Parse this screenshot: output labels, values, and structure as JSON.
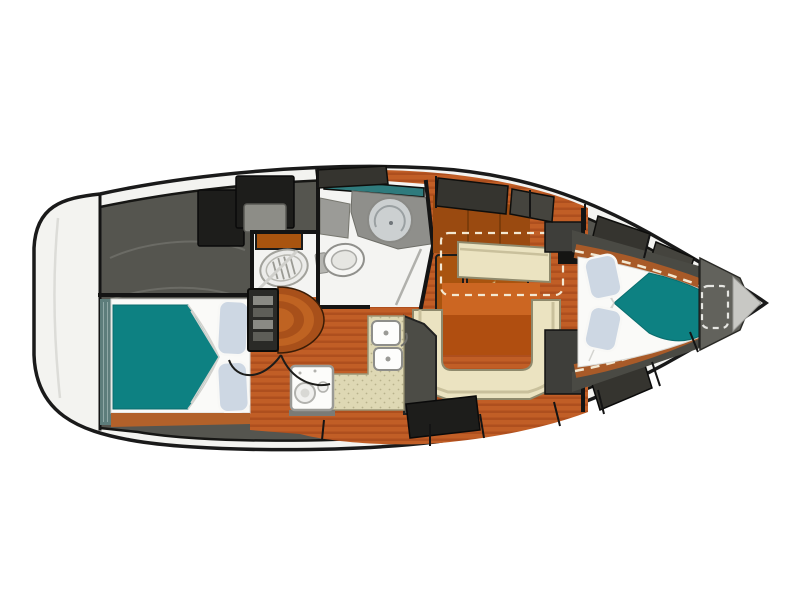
{
  "plan": {
    "kind": "sailboat-interior-floor-plan",
    "view": "top-down",
    "bow_direction": "right",
    "regions": [
      "swim-platform",
      "cockpit-storage",
      "aft-cabin-double-berth",
      "companionway-steps",
      "shower-room",
      "head-compartment",
      "companionway-entrance",
      "galley",
      "salon-settee",
      "salon-table",
      "nav-area",
      "v-berth-forward-cabin",
      "anchor-locker",
      "bow-tip"
    ],
    "arrow_meaning": "entrance-direction-arrow"
  },
  "palette": {
    "background": "#ffffff",
    "hull_fill": "#f3f3f0",
    "hull_outline": "#1a1a1a",
    "deck_gray": "#55554f",
    "deck_hatch_dark": "#35342f",
    "deck_hatch_mid": "#45443e",
    "deck_black": "#1d1d1b",
    "cockpit_panel": "#8d8d87",
    "floor_orange": "#c15e26",
    "floor_stripe": "#a8491a",
    "wood_trim": "#a85a28",
    "wood_shelf": "#b2612a",
    "cabinet_orange": "#a9540f",
    "cabinet_back": "#9a4a10",
    "table_top": "#cc6622",
    "table_base": "#b04e10",
    "steps_dark": "#a8501a",
    "steps_light": "#bf6322",
    "steps_cap": "#2a2a27",
    "settee_cream": "#ebe3c1",
    "settee_trim": "#c9c09c",
    "counter_speckle": "#ded8b4",
    "galley_wall": "#4c4c46",
    "bed_teal": "#0d8182",
    "mattress_white": "#fafaf8",
    "pillow_blue": "#cdd7e3",
    "bedhead_teal": "#5d7d7b",
    "bath_floor": "#f4f4f2",
    "fixture_gray": "#8f8f8b",
    "fixture_light": "#ccd0d1",
    "glass_teal": "#2f7b7d",
    "berth_wall_gray": "#4a4a44",
    "anchor_gray": "#62625c",
    "bow_tip_gray": "#c8c8c4",
    "arrow_cream": "#f7efe0",
    "dash_white": "#f3e8d2",
    "nav_block": "#3e3e3a"
  }
}
